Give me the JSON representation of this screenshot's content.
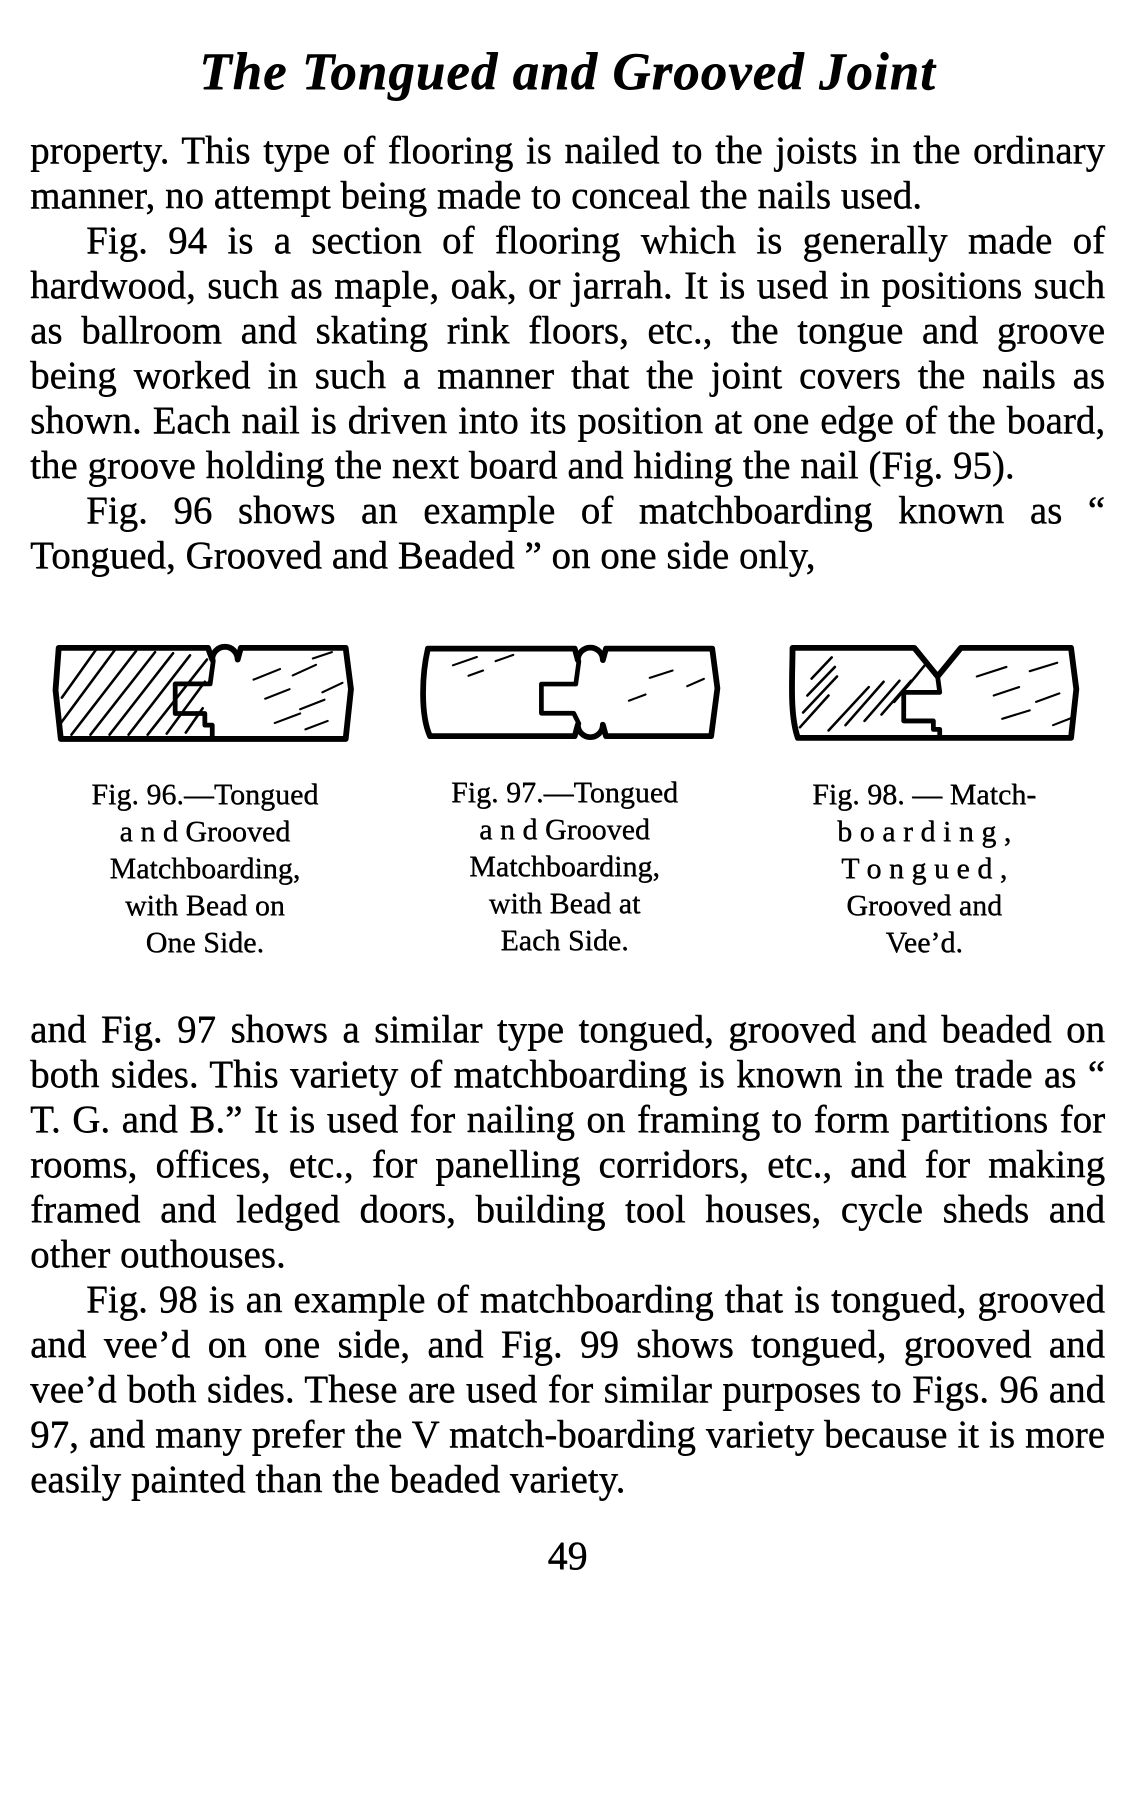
{
  "page": {
    "title": "The Tongued and Grooved Joint",
    "page_number": "49",
    "paragraphs": [
      {
        "text": "property.  This type of flooring is nailed to the joists in the ordinary manner, no attempt being made to conceal the nails used."
      },
      {
        "text": "Fig. 94 is a section of flooring which is generally made of hardwood, such as maple, oak, or jarrah.  It is used in positions such as ballroom and skating rink floors, etc., the tongue and groove being worked in such a manner that the joint covers the nails as shown.  Each nail is driven into its position at one edge of the board, the groove holding the next board and hiding the nail (Fig. 95)."
      },
      {
        "text": "Fig. 96 shows an example of matchboarding known as “ Tongued, Grooved and Beaded ” on one side only,"
      },
      {
        "text": "and Fig. 97 shows a similar type tongued, grooved and beaded on both sides.  This variety  of  matchboarding is known in the trade as “ T. G. and B.”   It is used for nailing on framing to form partitions for rooms, offices, etc., for panelling corridors, etc., and for making framed and ledged doors, building tool houses, cycle sheds and other outhouses."
      },
      {
        "text": "Fig. 98 is an example of matchboarding that is tongued, grooved and vee’d on one side, and Fig. 99 shows tongued, grooved and vee’d both sides.  These are used for similar purposes to Figs. 96 and 97, and many prefer the V match-boarding variety because it is more easily painted than the beaded variety."
      }
    ],
    "figures": [
      {
        "name": "fig-96",
        "alt": "Cross-section of tongued and grooved matchboarding with a bead on one side",
        "caption_lines": [
          "Fig. 96.—Tongued",
          "a n d  Grooved",
          "Matchboarding,",
          "with  Bead  on",
          "One Side."
        ]
      },
      {
        "name": "fig-97",
        "alt": "Cross-section of tongued and grooved matchboarding with a bead at each side",
        "caption_lines": [
          "Fig. 97.—Tongued",
          "a n d  Grooved",
          "Matchboarding,",
          "with  Bead  at",
          "Each Side."
        ]
      },
      {
        "name": "fig-98",
        "alt": "Cross-section of matchboarding, tongued, grooved and vee'd",
        "caption_lines": [
          "Fig. 98. — Match-",
          "b o a r d i n g ,",
          "T o n g u e d ,",
          "Grooved  and",
          "Vee’d."
        ]
      }
    ]
  }
}
